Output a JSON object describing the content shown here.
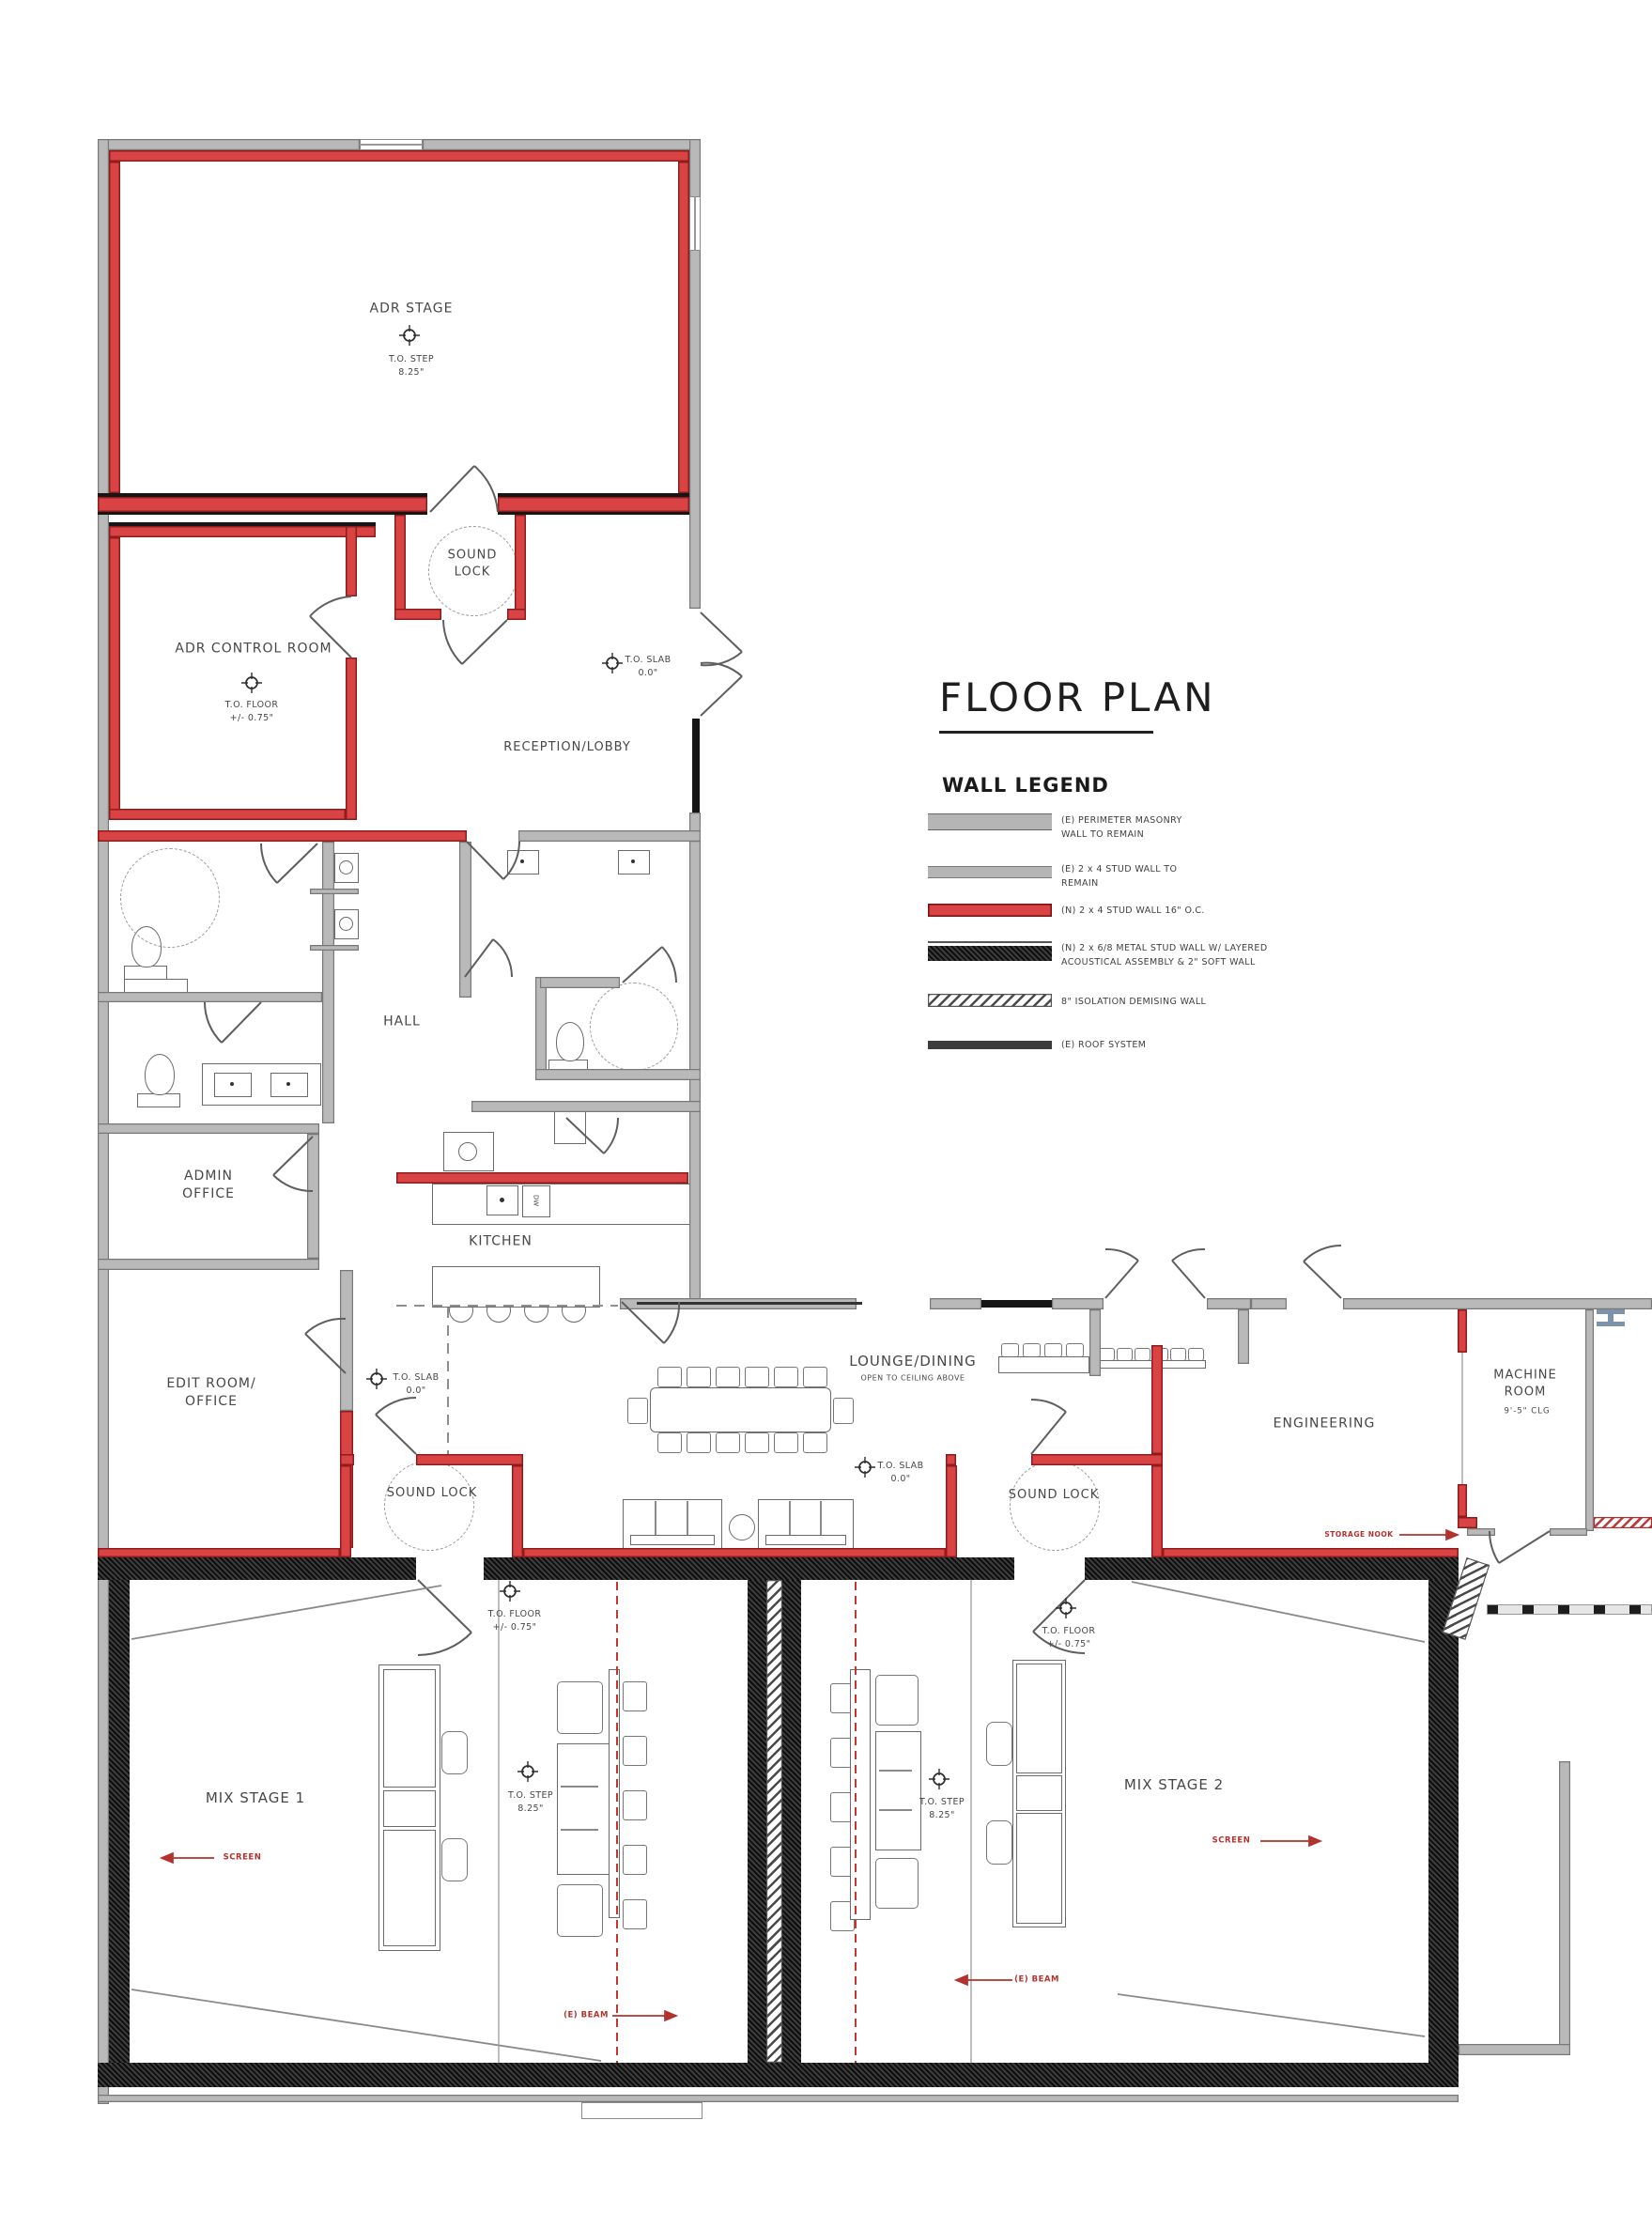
{
  "title": "FLOOR PLAN",
  "legend": {
    "heading": "WALL LEGEND",
    "items": [
      {
        "name": "perimeter-masonry",
        "label": "(E) PERIMETER MASONRY\nWALL TO REMAIN"
      },
      {
        "name": "existing-stud-wall",
        "label": "(E) 2 x 4 STUD WALL TO\nREMAIN"
      },
      {
        "name": "new-stud-wall",
        "label": "(N) 2 x 4 STUD WALL 16\" O.C."
      },
      {
        "name": "metal-stud-acoustic-wall",
        "label": "(N) 2 x 6/8 METAL STUD WALL W/ LAYERED\nACOUSTICAL ASSEMBLY & 2\" SOFT WALL"
      },
      {
        "name": "isolation-demising-wall",
        "label": "8\" ISOLATION DEMISING WALL"
      },
      {
        "name": "roof-system",
        "label": "(E) ROOF SYSTEM"
      }
    ]
  },
  "rooms": {
    "adr_stage": "ADR STAGE",
    "adr_control": "ADR CONTROL ROOM",
    "sound_lock_top": "SOUND\nLOCK",
    "reception": "RECEPTION/LOBBY",
    "hall": "HALL",
    "admin": "ADMIN\nOFFICE",
    "kitchen": "KITCHEN",
    "edit": "EDIT ROOM/\nOFFICE",
    "lounge": "LOUNGE/DINING",
    "lounge_sub": "OPEN TO CEILING ABOVE",
    "sound_lock": "SOUND LOCK",
    "engineering": "ENGINEERING",
    "machine": "MACHINE\nROOM",
    "machine_clg": "9'-5\" CLG",
    "mix1": "MIX STAGE 1",
    "mix2": "MIX STAGE 2"
  },
  "markers": {
    "to_step": "T.O. STEP\n8.25\"",
    "to_slab": "T.O. SLAB\n0.0\"",
    "to_floor": "T.O. FLOOR\n+/- 0.75\""
  },
  "annotations": {
    "screen": "SCREEN",
    "beam": "(E) BEAM",
    "storage": "STORAGE NOOK",
    "dw": "DW"
  },
  "colors": {
    "new_wall_red": "#da4343",
    "masonry_gray": "#b9b9b9",
    "acoustic_black": "#1c1c1c",
    "annotation_red": "#b3322e"
  }
}
